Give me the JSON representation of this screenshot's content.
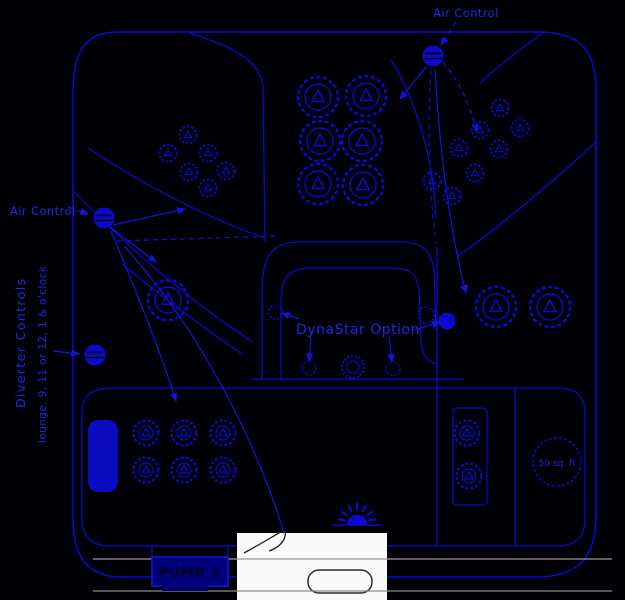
{
  "diagram": {
    "labels": {
      "air_control_top": "Air Control",
      "air_control_left": "Air Control",
      "diverter_line1": "Diverter Controls",
      "diverter_line2": "lounge, 9, 11 or 12, 1 & o'clock",
      "dynastar_option": "DynaStar Option",
      "filter_size": "50 sq. ft",
      "pump_label": "PUMP 1"
    },
    "colors": {
      "background": "#000006",
      "line_blue": "#0b0bd0",
      "label_blue": "#2626e0",
      "pump_box_fill": "#00007d",
      "pump_text": "#000016",
      "gray_line": "#9a9a9a",
      "white_panel": "#fafafa"
    },
    "features": {
      "jet_counts": {
        "top_left_small_cluster": 6,
        "top_center_large_cluster": 6,
        "top_right_small_cluster": 8,
        "left_seat_large": 1,
        "right_seat_large": 2,
        "bottom_seat_medium": 6,
        "equipment_bay_small": 2,
        "dynastar_lounge_jets": 5
      },
      "controls": {
        "air_controls": 2,
        "diverter_controls": 1
      },
      "other": [
        "spa-light",
        "filter-50-sq-ft",
        "head-pillow"
      ]
    }
  }
}
